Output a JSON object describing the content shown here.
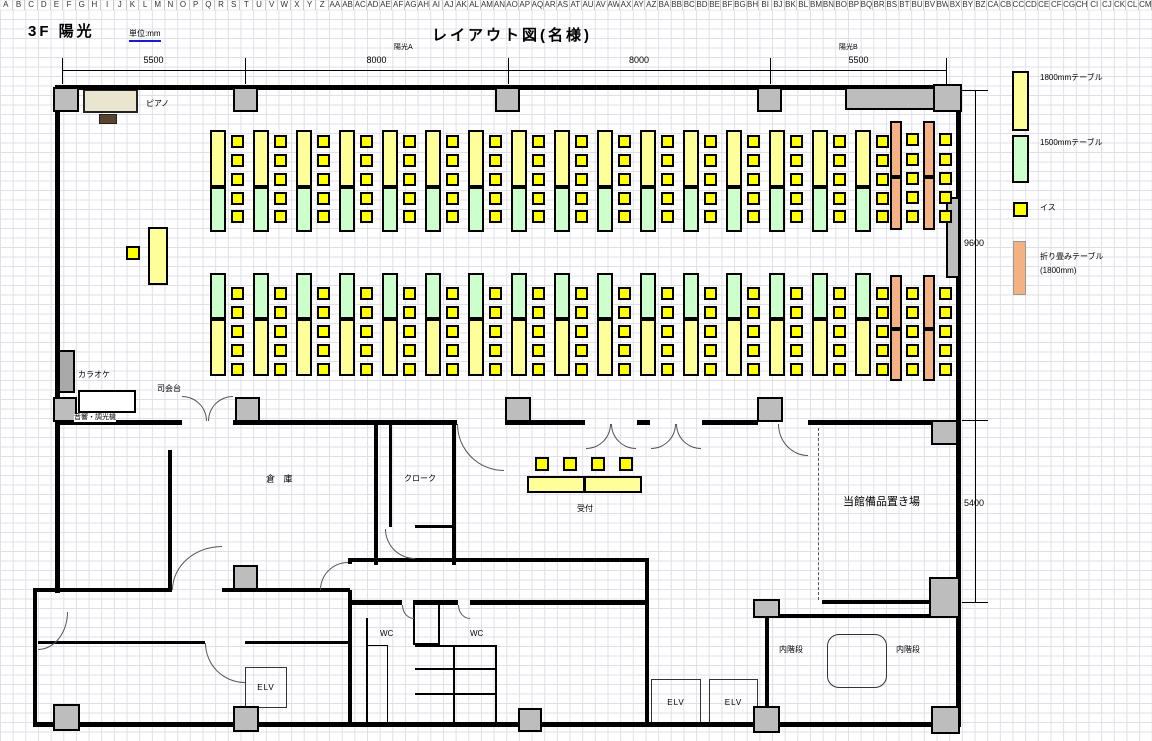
{
  "sheet": {
    "column_headers": [
      "A",
      "B",
      "C",
      "D",
      "E",
      "F",
      "G",
      "H",
      "I",
      "J",
      "K",
      "L",
      "M",
      "N",
      "O",
      "P",
      "Q",
      "R",
      "S",
      "T",
      "U",
      "V",
      "W",
      "X",
      "Y",
      "Z",
      "AA",
      "AB",
      "AC",
      "AD",
      "AE",
      "AF",
      "AG",
      "AH",
      "AI",
      "AJ",
      "AK",
      "AL",
      "AM",
      "AN",
      "AO",
      "AP",
      "AQ",
      "AR",
      "AS",
      "AT",
      "AU",
      "AV",
      "AW",
      "AX",
      "AY",
      "AZ",
      "BA",
      "BB",
      "BC",
      "BD",
      "BE",
      "BF",
      "BG",
      "BH",
      "BI",
      "BJ",
      "BK",
      "BL",
      "BM",
      "BN",
      "BO",
      "BP",
      "BQ",
      "BR",
      "BS",
      "BT",
      "BU",
      "BV",
      "BW",
      "BX",
      "BY",
      "BZ",
      "CA",
      "CB",
      "CC",
      "CD",
      "CE",
      "CF",
      "CG",
      "CH",
      "CI",
      "CJ",
      "CK",
      "CL",
      "CM"
    ]
  },
  "header": {
    "floor_label": "3F 陽光",
    "unit_label": "単位:mm",
    "title": "レイアウト図(名様)"
  },
  "dimensions": {
    "top": [
      "5500",
      "8000",
      "8000",
      "5500"
    ],
    "right": [
      "9600",
      "5400"
    ],
    "sections": [
      "陽光A",
      "陽光B"
    ]
  },
  "legend": [
    {
      "label": "1800mmテーブル",
      "color": "#FFFF99"
    },
    {
      "label": "1500mmテーブル",
      "color": "#CCFFCC"
    },
    {
      "label": "イス",
      "color": "#FFFF00"
    },
    {
      "label": "折り畳みテーブル",
      "label2": "(1800mm)",
      "color": "#F4B183"
    }
  ],
  "rooms": {
    "piano": "ピアノ",
    "karaoke": "カラオケ",
    "mc_stand": "司会台",
    "audio": "音響・調光機",
    "storage": "倉 庫",
    "cloak": "クローク",
    "reception": "受付",
    "equipment_storage": "当館備品置き場",
    "wc": "WC",
    "elevator": "ELV",
    "stairs": "内階段"
  },
  "colors": {
    "table_1800": "#FFFF99",
    "table_1500": "#CCFFCC",
    "chair": "#FFFF00",
    "folding_table": "#F4B183",
    "pillar": "#BDBDBD",
    "wall": "#000000",
    "piano_body": "#E9E5D1",
    "piano_bench": "#57452E",
    "karaoke": "#A9A9A9"
  }
}
